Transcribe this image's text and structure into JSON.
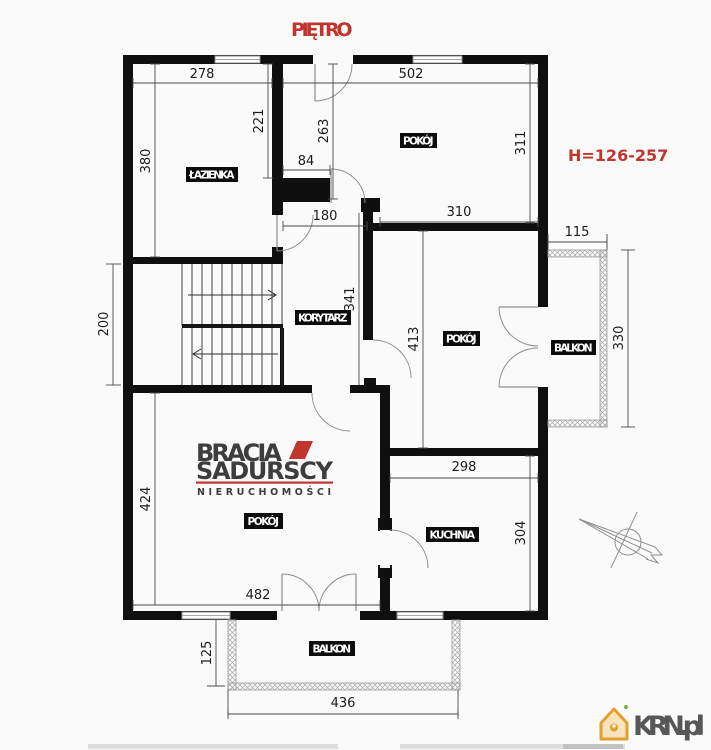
{
  "page": {
    "title": "PIĘTRO",
    "height_note": "H=126-257"
  },
  "colors": {
    "accent_red": "#c0352e",
    "wall_black": "#0f0f0f",
    "krn_orange": "#e2a02c",
    "logo_gray": "#3d3d3d",
    "krn_text_gray": "#575757"
  },
  "rooms": {
    "bathroom": "ŁAZIENKA",
    "room_top": "POKÓJ",
    "corridor": "KORYTARZ",
    "room_middle": "POKÓJ",
    "balcony_right": "BALKON",
    "room_bottom": "POKÓJ",
    "kitchen": "KUCHNIA",
    "balcony_bottom": "BALKON"
  },
  "dimensions_cm": {
    "d278": "278",
    "d502": "502",
    "d380": "380",
    "d221": "221",
    "d263": "263",
    "d311": "311",
    "d84": "84",
    "d180": "180",
    "d310": "310",
    "d115": "115",
    "d200": "200",
    "d341": "341",
    "d413": "413",
    "d330": "330",
    "d424": "424",
    "d482": "482",
    "d298": "298",
    "d304": "304",
    "d125": "125",
    "d436": "436"
  },
  "watermark": {
    "line1": "BRACIA",
    "line2": "SADURSCY",
    "line3": "NIERUCHOMOŚCI"
  },
  "footer": {
    "portal": "KRN.pl"
  }
}
